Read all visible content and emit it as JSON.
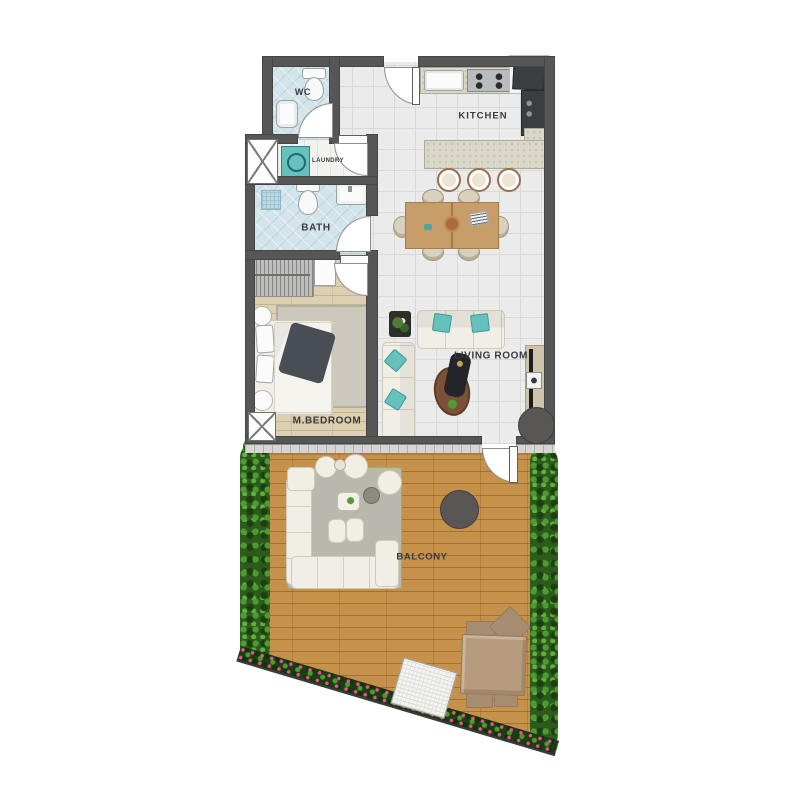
{
  "rooms": {
    "wc": {
      "label": "WC"
    },
    "kitchen": {
      "label": "KITCHEN"
    },
    "laundry": {
      "label": "LAUNDRY"
    },
    "bath": {
      "label": "BATH"
    },
    "bedroom": {
      "label": "M.BEDROOM"
    },
    "living": {
      "label": "LIVING ROOM"
    },
    "balcony": {
      "label": "BALCONY"
    }
  },
  "palette": {
    "wall": "#565656",
    "tile": "#ebebeb",
    "tile_line": "#d9d9d9",
    "wet": "#d4e4eb",
    "wood": "#ddd0b2",
    "deck": "#c6924b",
    "counter": "#dad7c9",
    "dark_appliance": "#3b3e41",
    "accent_teal": "#66c1bd",
    "sofa": "#f1eee6",
    "hedge": "#2b5c1c",
    "hedge_light": "#4f9a33",
    "flower": "#e05a8c",
    "tan": "#b79b7e",
    "circle_dark": "#585755",
    "label": "#3b3b3d"
  }
}
